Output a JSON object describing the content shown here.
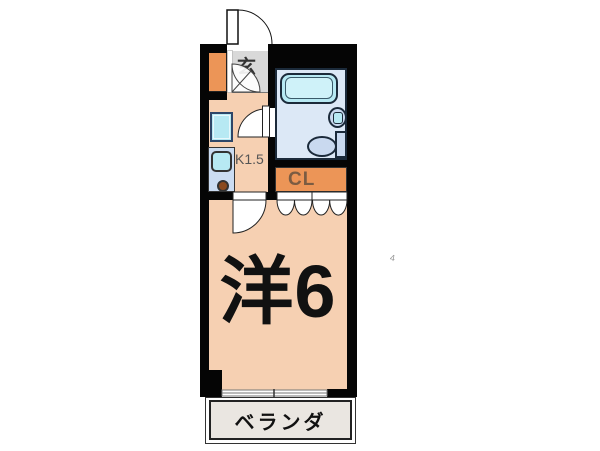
{
  "floorplan": {
    "type": "japanese-apartment-1K",
    "labels": {
      "entrance": "玄",
      "kitchen": "K1.5",
      "closet": "CL",
      "main_room": "洋6",
      "balcony": "ベランダ"
    },
    "fixtures": [
      "entrance-door",
      "shoe-cabinet",
      "bathtub",
      "washbasin",
      "toilet",
      "bathroom-door",
      "kitchen-window",
      "kitchen-sink",
      "stove-burner",
      "room-door",
      "closet-bifold-doors",
      "sliding-window",
      "balcony"
    ],
    "colors": {
      "wall": "#050505",
      "floor_peach": "#f6d0b2",
      "entrance_gray": "#d9d9d9",
      "cabinet_orange": "#ec9557",
      "closet_orange": "#ec9557",
      "bath_floor": "#dce8f6",
      "tub_cyan": "#b7e9f3",
      "fixture_blue": "#c9d9ef",
      "counter_blue": "#cbdcf2",
      "balcony_floor": "#eae6e1"
    },
    "stray_mark": "4"
  }
}
